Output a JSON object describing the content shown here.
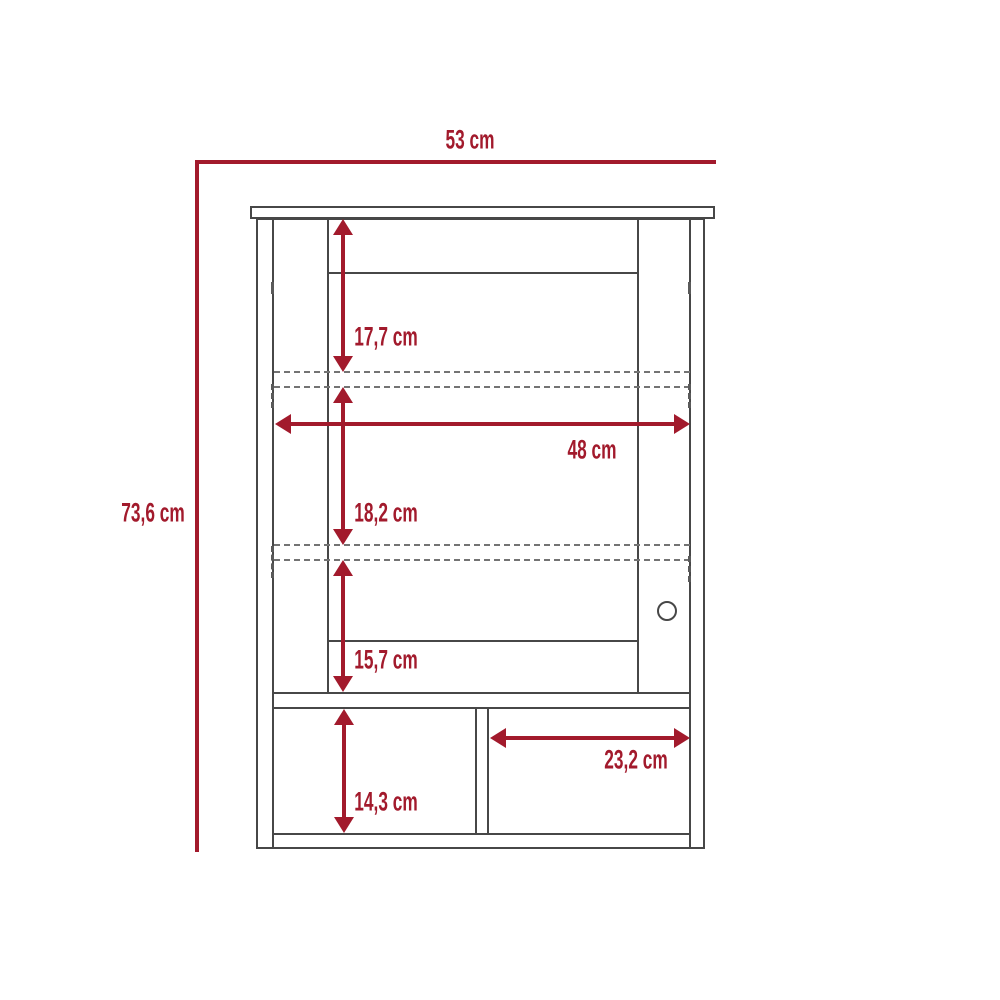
{
  "diagram": {
    "type": "furniture-dimension-drawing",
    "unit": "cm",
    "accent_color": "#a21a2c",
    "outline_color": "#474747",
    "dashed_line_color": "#737373",
    "dimensions": {
      "overall_width": {
        "label": "53 cm",
        "value_cm": 53
      },
      "overall_height": {
        "label": "73,6 cm",
        "value_cm": 73.6
      },
      "upper_section_height": {
        "label": "17,7 cm",
        "value_cm": 17.7
      },
      "interior_width": {
        "label": "48 cm",
        "value_cm": 48
      },
      "middle_section_height": {
        "label": "18,2 cm",
        "value_cm": 18.2
      },
      "lower_section_height": {
        "label": "15,7 cm",
        "value_cm": 15.7
      },
      "open_shelf_width": {
        "label": "23,2 cm",
        "value_cm": 23.2
      },
      "open_shelf_height": {
        "label": "14,3 cm",
        "value_cm": 14.3
      }
    }
  }
}
